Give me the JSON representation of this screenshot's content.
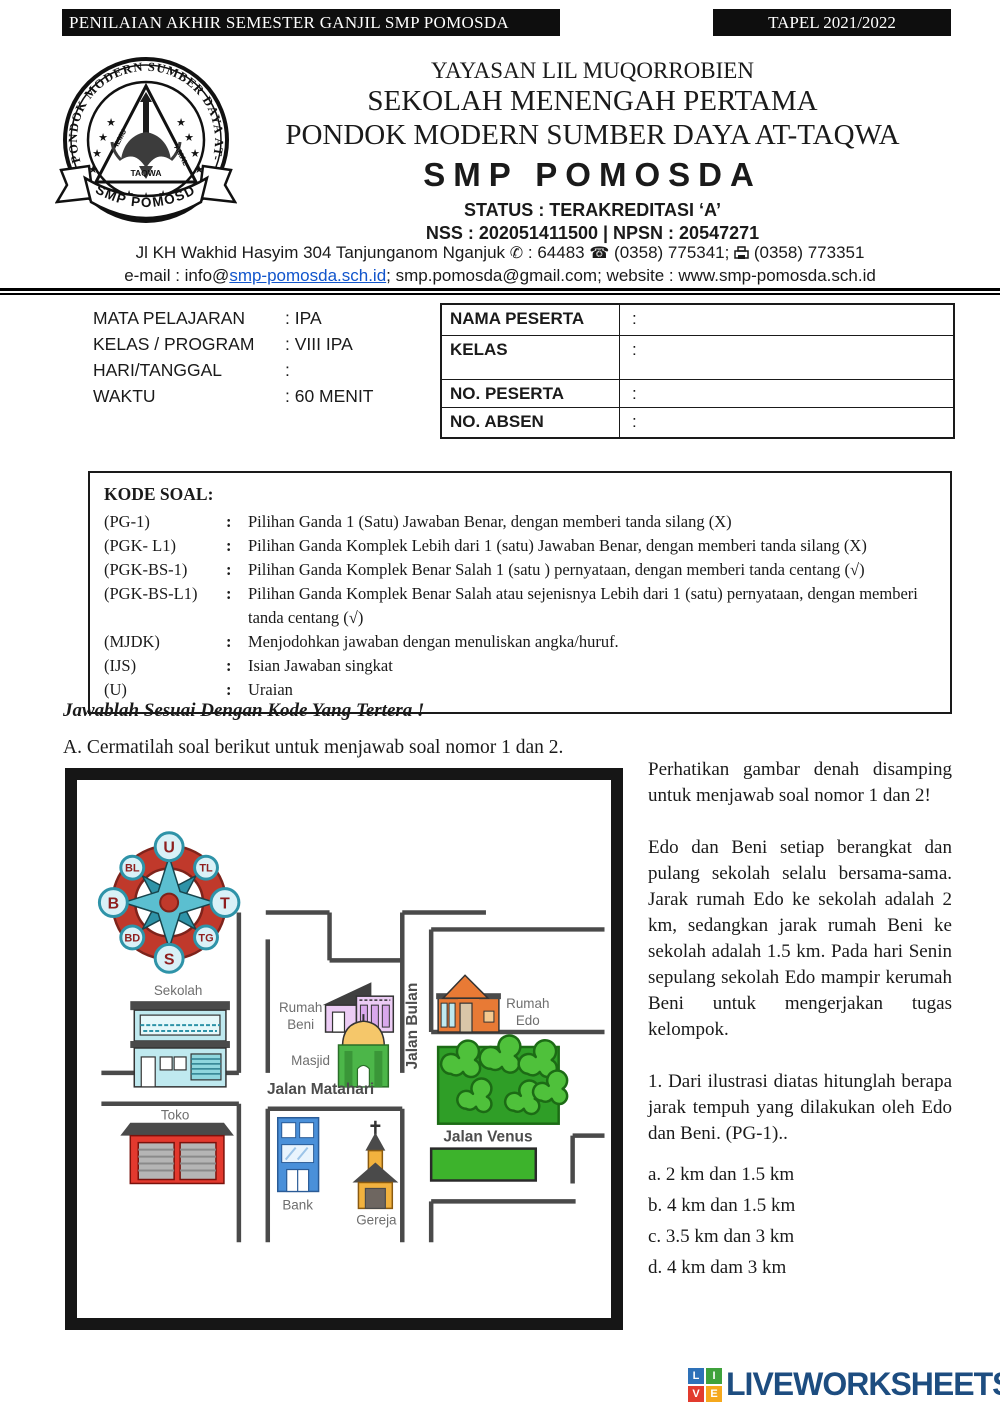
{
  "header_bars": {
    "left": "PENILAIAN AKHIR SEMESTER GANJIL SMP POMOSDA",
    "right": "TAPEL 2021/2022"
  },
  "letterhead": {
    "foundation": "YAYASAN LIL MUQORROBIEN",
    "school_type": "SEKOLAH MENENGAH PERTAMA",
    "pondok": "PONDOK MODERN SUMBER DAYA AT-TAQWA",
    "school_name": "SMP POMOSDA",
    "status": "STATUS : TERAKREDITASI ‘A’",
    "ids": "NSS : 202051411500 | NPSN : 20547271",
    "address_pre": "Jl KH Wakhid Hasyim 304 Tanjunganom Nganjuk",
    "postal": ": 64483",
    "phone": "(0358) 775341;",
    "fax": "(0358) 773351",
    "phone_icon": "✆",
    "telephone_icon": "☎",
    "email_pre": "e-mail : info@",
    "email_link": "smp-pomosda.sch.id",
    "email_post": "; smp.pomosda@gmail.com; website : www.smp-pomosda.sch.id",
    "seal": {
      "ring_text": "PONDOK MODERN SUMBER DAYA AT-TAQWA",
      "ribbon": "SMP POMOSDA",
      "word_left": "ILMU",
      "word_right": "AMAL",
      "word_bottom": "TAQWA"
    }
  },
  "exam_info": {
    "left": [
      {
        "label": "MATA PELAJARAN",
        "value": ": IPA"
      },
      {
        "label": "KELAS / PROGRAM",
        "value": ": VIII IPA"
      },
      {
        "label": "HARI/TANGGAL",
        "value": ":"
      },
      {
        "label": "WAKTU",
        "value": ": 60 MENIT"
      }
    ],
    "right": [
      {
        "label": "NAMA PESERTA",
        "value": ":"
      },
      {
        "label": "KELAS",
        "value": ":"
      },
      {
        "label": "NO. PESERTA",
        "value": ":"
      },
      {
        "label": "NO. ABSEN",
        "value": ":"
      }
    ]
  },
  "kode_soal": {
    "title": "KODE SOAL:",
    "sep": ":",
    "rows": [
      {
        "code": "(PG-1)",
        "desc": "Pilihan Ganda 1 (Satu) Jawaban Benar, dengan memberi tanda silang (X)"
      },
      {
        "code": "(PGK- L1)",
        "desc": "Pilihan Ganda Komplek Lebih dari 1 (satu) Jawaban Benar, dengan memberi tanda silang (X)"
      },
      {
        "code": "(PGK-BS-1)",
        "desc": "Pilihan Ganda Komplek Benar Salah 1 (satu ) pernyataan, dengan memberi tanda centang (√)"
      },
      {
        "code": "(PGK-BS-L1)",
        "desc": "Pilihan Ganda Komplek Benar Salah atau sejenisnya Lebih dari 1 (satu) pernyataan, dengan memberi tanda centang (√)"
      },
      {
        "code": "(MJDK)",
        "desc": "Menjodohkan jawaban dengan menuliskan angka/huruf."
      },
      {
        "code": "(IJS)",
        "desc": "Isian Jawaban singkat"
      },
      {
        "code": "(U)",
        "desc": "Uraian"
      }
    ]
  },
  "instruction": "Jawablah Sesuai Dengan Kode Yang Tertera !",
  "section_a": "A. Cermatilah soal berikut untuk menjawab soal nomor 1 dan 2.",
  "map": {
    "compass": {
      "n": "U",
      "s": "S",
      "w": "B",
      "e": "T",
      "nw": "BL",
      "ne": "TL",
      "sw": "BD",
      "se": "TG"
    },
    "labels": {
      "sekolah": "Sekolah",
      "rumah_beni_1": "Rumah",
      "rumah_beni_2": "Beni",
      "masjid": "Masjid",
      "rumah_edo_1": "Rumah",
      "rumah_edo_2": "Edo",
      "toko": "Toko",
      "bank": "Bank",
      "gereja": "Gereja",
      "jalan_matahari": "Jalan Matahari",
      "jalan_bulan": "Jalan Bulan",
      "jalan_venus": "Jalan Venus"
    }
  },
  "problem": {
    "intro": "Perhatikan gambar denah disamping untuk menjawab soal nomor 1 dan 2!",
    "story": "Edo dan Beni setiap berangkat dan pulang sekolah selalu bersama-sama. Jarak rumah Edo ke sekolah adalah 2 km, sedangkan jarak rumah Beni ke sekolah adalah 1.5 km. Pada hari Senin sepulang sekolah Edo mampir kerumah Beni untuk mengerjakan tugas kelompok.",
    "question": "1. Dari ilustrasi diatas hitunglah berapa jarak tempuh yang dilakukan oleh Edo dan Beni. (PG-1)..",
    "options": [
      "a. 2 km dan 1.5 km",
      "b. 4 km dan 1.5 km",
      "c. 3.5 km dan 3 km",
      "d. 4 km dam 3 km"
    ]
  },
  "footer": {
    "brand": "LIVEWORKSHEETS",
    "brand_color": "#1d4d80",
    "tiles": [
      {
        "letter": "L",
        "color": "#2e71b8"
      },
      {
        "letter": "I",
        "color": "#3fa23c"
      },
      {
        "letter": "V",
        "color": "#e23b2e"
      },
      {
        "letter": "E",
        "color": "#f5a81c"
      }
    ]
  }
}
